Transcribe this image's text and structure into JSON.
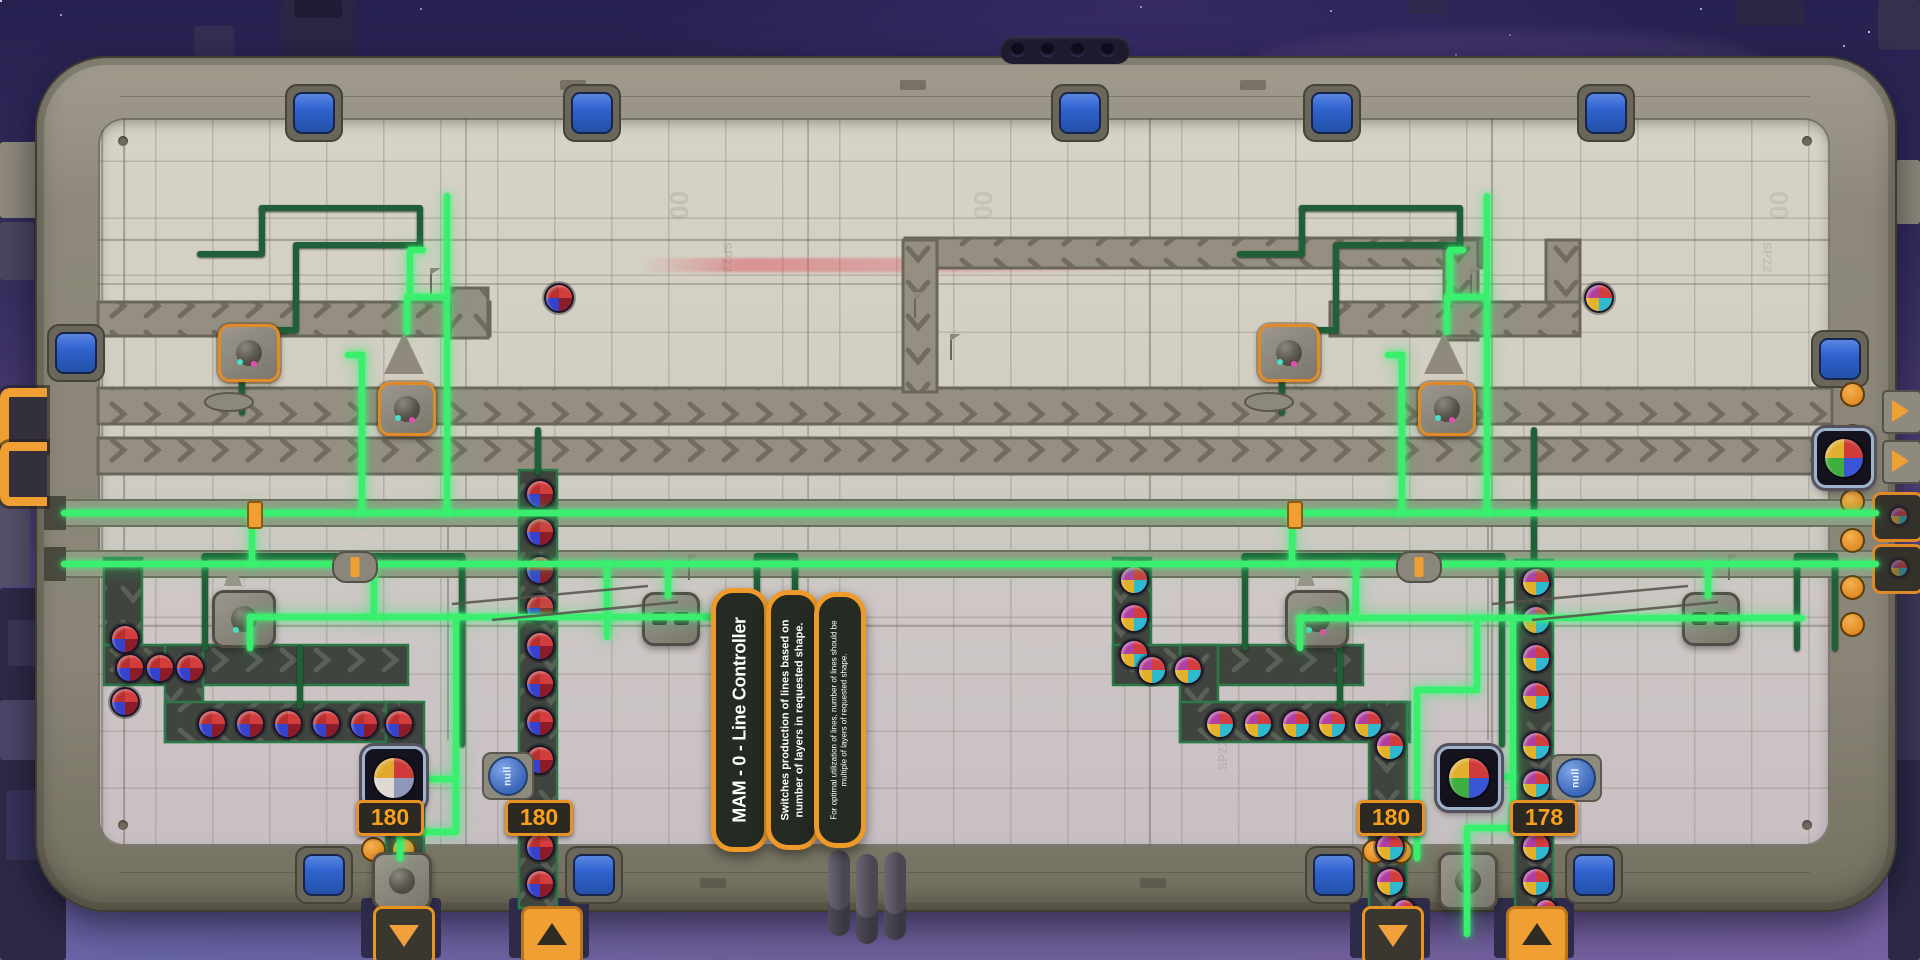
{
  "colors": {
    "wire_active": "#3bef6e",
    "pipe_inactive": "#1f6038",
    "accent_orange": "#f0a032",
    "badge_text": "#f6a01e",
    "port_blue": "#2f63cf"
  },
  "signs": {
    "title": "MAM - 0 - Line Controller",
    "description": "Switches production of lines based on number of layers in requested shape.",
    "note": "For optimal utilization of lines, number of lines should be multiple of layers of requested shape."
  },
  "counters": [
    {
      "value": "180"
    },
    {
      "value": "180"
    },
    {
      "value": "180"
    },
    {
      "value": "178"
    }
  ],
  "signals": [
    {
      "value": "null"
    },
    {
      "value": "null"
    }
  ],
  "floor_decals": {
    "zero": "00",
    "code": "SPZ2"
  },
  "shape_palettes": {
    "ruby": [
      "#d23d3d",
      "#8c1d28",
      "#3742cc",
      "#b92f2f"
    ],
    "mixed": [
      "#d23d3d",
      "#2fb9cf",
      "#e3b02a",
      "#b03fa0"
    ],
    "display_left": [
      "#cf3b3b",
      "#8f98b8",
      "#ded9d2",
      "#e0a82e"
    ],
    "display_right": [
      "#cf3b3b",
      "#3a55d6",
      "#3fae3f",
      "#e0b02e"
    ]
  }
}
